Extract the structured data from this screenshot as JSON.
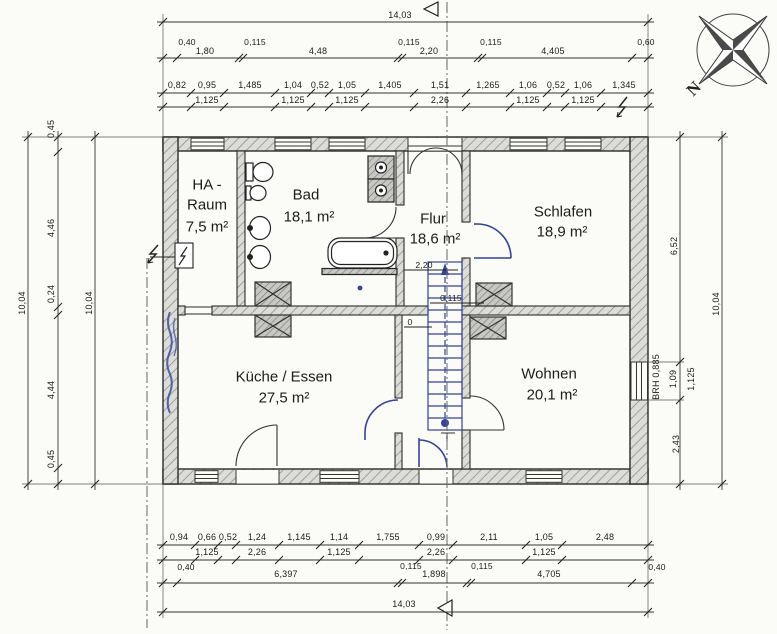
{
  "rooms": {
    "ha": {
      "l1": "HA -",
      "l2": "Raum",
      "area": "7,5 m²"
    },
    "bad": {
      "name": "Bad",
      "area": "18,1 m²"
    },
    "flur": {
      "name": "Flur",
      "area": "18,6 m²"
    },
    "schlafen": {
      "name": "Schlafen",
      "area": "18,9 m²"
    },
    "kueche": {
      "name": "Küche / Essen",
      "area": "27,5 m²"
    },
    "wohnen": {
      "name": "Wohnen",
      "area": "20,1 m²"
    }
  },
  "stair": {
    "headroom": "2,20",
    "wall": "0,115",
    "level": "0"
  },
  "window_note": {
    "brh": "BRH  0,885"
  },
  "compass": {
    "label": "N"
  },
  "dims": {
    "top": {
      "total": "14,03",
      "row2": [
        "0,40",
        "1,80",
        "0,115",
        "4,48",
        "0,115",
        "2,20",
        "0,115",
        "4,405",
        "0,60"
      ],
      "row3": [
        "0,82",
        "0,95",
        "1,485",
        "1,04",
        "0,52",
        "1,05",
        "1,405",
        "1,51",
        "1,265",
        "1,06",
        "0,52",
        "1,06",
        "1,345"
      ],
      "sills": [
        "1,125",
        "1,125",
        "1,125",
        "2,26",
        "1,125",
        "1,125"
      ]
    },
    "bottom": {
      "row1": [
        "0,94",
        "0,66",
        "0,52",
        "1,24",
        "1,145",
        "1,14",
        "1,755",
        "0,99",
        "2,11",
        "1,05",
        "2,48"
      ],
      "sills": [
        "1,125",
        "2,26",
        "1,125",
        "2,26",
        "1,125"
      ],
      "row2": [
        "0,40",
        "6,397",
        "0,115",
        "1,898",
        "0,115",
        "4,705",
        "0,40"
      ],
      "total": "14,03"
    },
    "left": {
      "outer": "10,04",
      "segments": [
        "0,45",
        "4,46",
        "0,24",
        "4,44",
        "0,45"
      ],
      "inner": "10,04"
    },
    "right": {
      "segments": [
        "6,52",
        "1,09",
        "2,43"
      ],
      "sill": "1,125",
      "outer": "10,04"
    }
  }
}
